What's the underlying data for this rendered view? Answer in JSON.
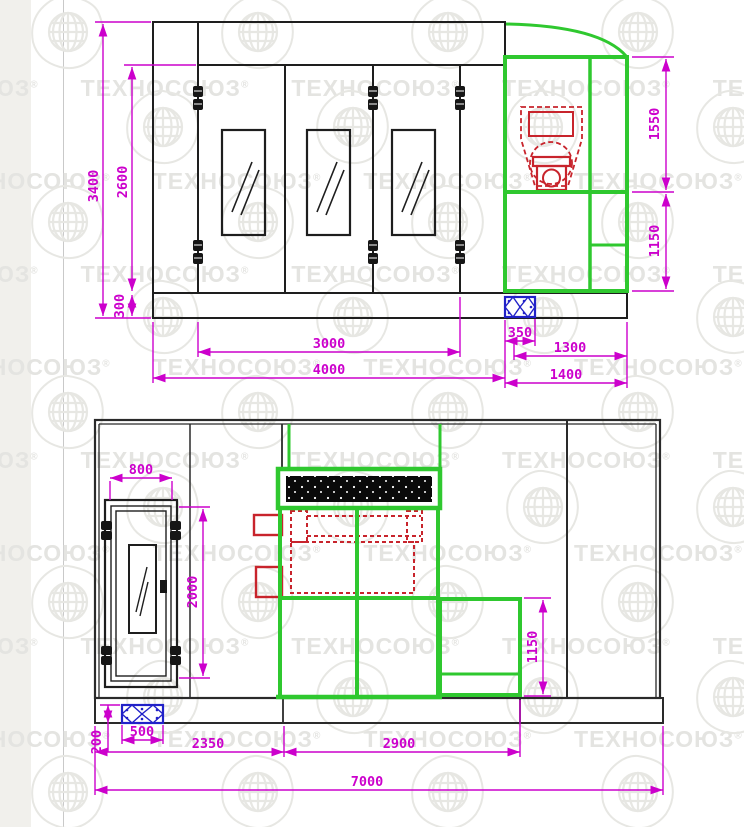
{
  "watermark": {
    "text": "ТЕХНОСОЮЗ",
    "reg": "®"
  },
  "colors": {
    "dimension_magenta": "#cc00cc",
    "structure_black": "#1e1e1e",
    "frame_green": "#2fc82f",
    "equipment_red": "#c8242c",
    "hatch_blue": "#2121c8",
    "watermark_gray": "#e4e4e1",
    "page_strip": "#f1f0ec"
  },
  "front_view": {
    "title": "front elevation",
    "dims": {
      "total_height": "3400",
      "door_opening_height": "2600",
      "base_height": "300",
      "door_opening_width": "3000",
      "overall_width": "4000",
      "pit_width": "350",
      "annex_clear_width": "1300",
      "annex_width": "1400",
      "annex_upper_height": "1550",
      "annex_lower_height": "1150"
    }
  },
  "side_view": {
    "title": "side elevation",
    "dims": {
      "door_width": "800",
      "door_height": "2000",
      "pit_width": "500",
      "pit_depth": "200",
      "entry_bay_length": "2350",
      "service_bay_length": "2900",
      "service_height": "1150",
      "overall_length": "7000"
    }
  }
}
